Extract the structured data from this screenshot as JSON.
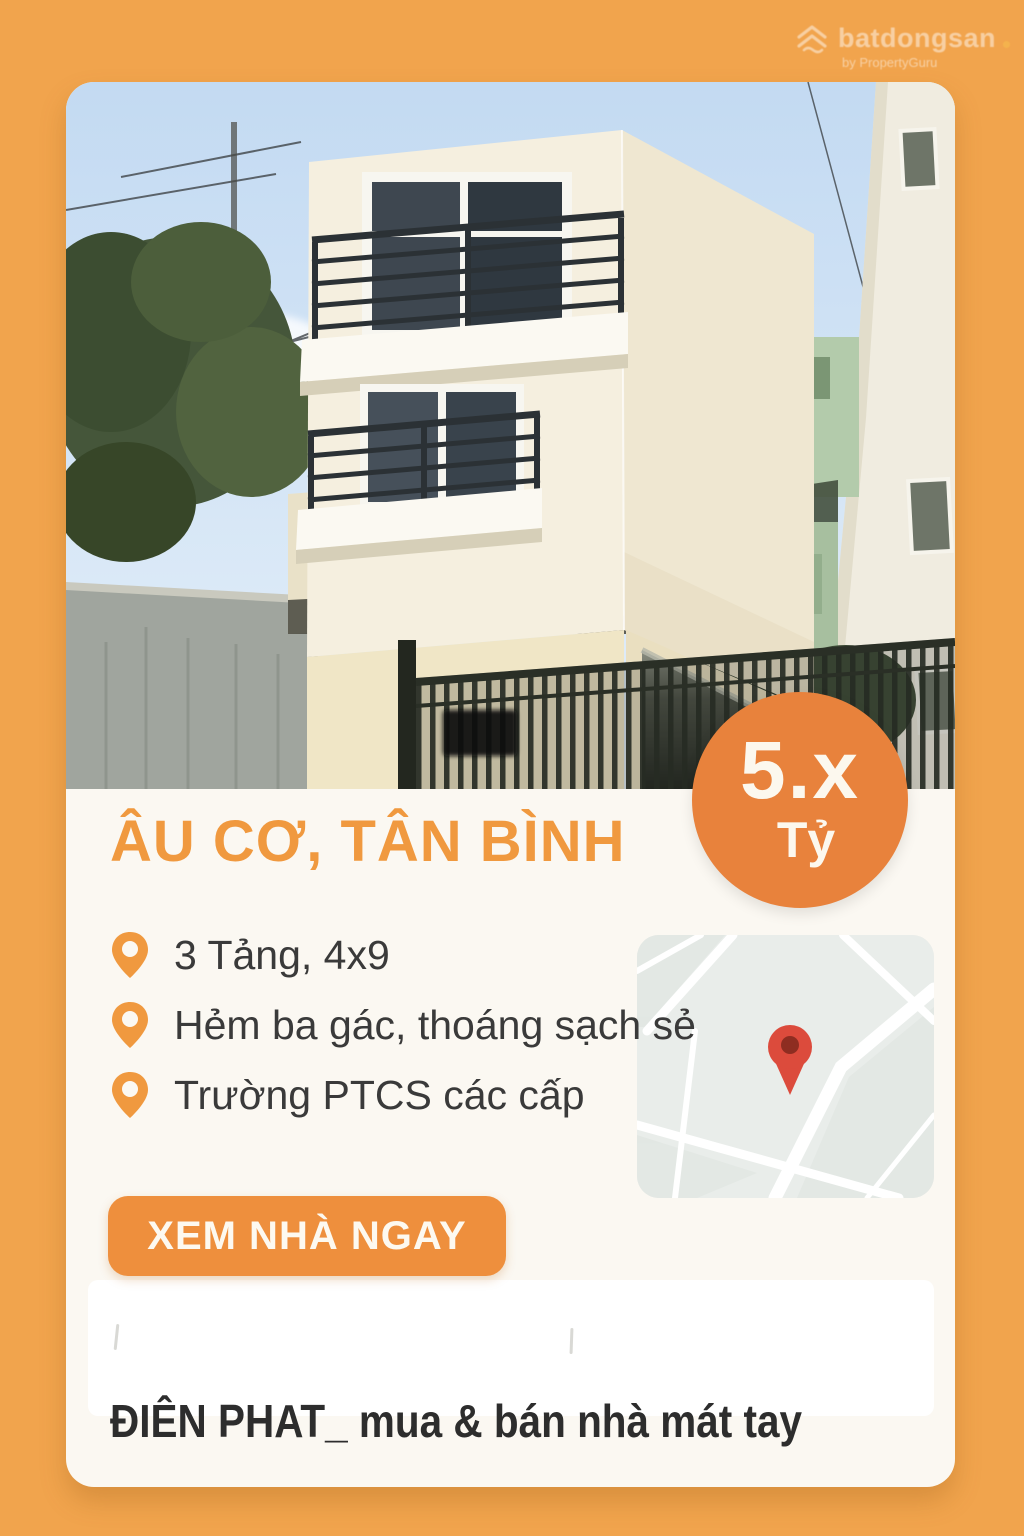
{
  "watermark": {
    "brand": "batdongsan",
    "byline": "by PropertyGuru"
  },
  "price_badge": {
    "value": "5.x",
    "unit": "Tỷ"
  },
  "listing": {
    "title": "ÂU CƠ, TÂN BÌNH",
    "features": [
      "3 Tảng, 4x9",
      "Hẻm ba gác, thoáng sạch sẻ",
      "Trường PTCS các cấp"
    ],
    "cta_label": "XEM NHÀ NGAY",
    "agent_tagline": "ĐIÊN PHAT_ mua & bán nhà mát tay"
  },
  "icons": {
    "feature_bullet": "location-pin",
    "map_marker": "map-pin",
    "brand_logo": "house-chevrons"
  },
  "colors": {
    "background_orange": "#F1A44D",
    "badge_orange": "#E8823C",
    "accent_orange": "#F0993F",
    "button_orange": "#EE8F3D",
    "text_dark": "#3A3A3A",
    "card_background": "#FBF8F2",
    "map_pin_red": "#DC4B3C"
  }
}
